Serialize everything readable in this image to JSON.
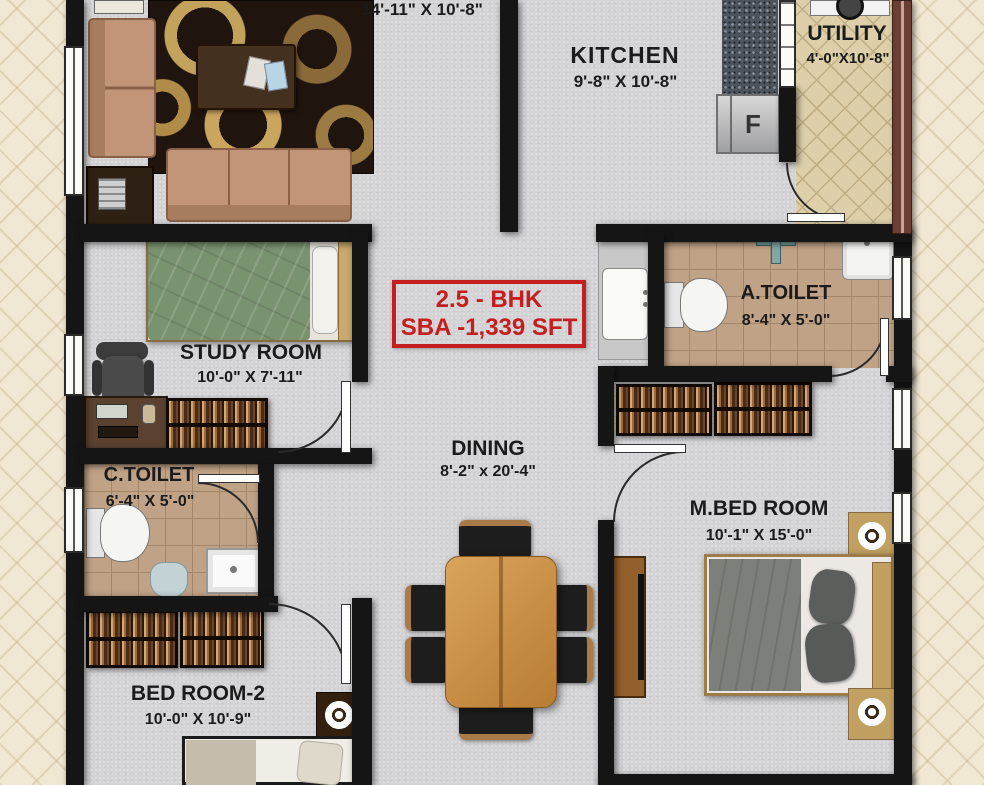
{
  "badge": {
    "line1": "2.5 - BHK",
    "line2": "SBA -1,339 SFT"
  },
  "rooms": {
    "living": {
      "dims": "14'-11\" X 10'-8\""
    },
    "kitchen": {
      "name": "KITCHEN",
      "dims": "9'-8\" X 10'-8\""
    },
    "utility": {
      "name": "UTILITY",
      "dims": "4'-0\"X10'-8\""
    },
    "a_toilet": {
      "name": "A.TOILET",
      "dims": "8'-4\" X 5'-0\""
    },
    "study": {
      "name": "STUDY ROOM",
      "dims": "10'-0\" X 7'-11\""
    },
    "dining": {
      "name": "DINING",
      "dims": "8'-2\" x 20'-4\""
    },
    "c_toilet": {
      "name": "C.TOILET",
      "dims": "6'-4\" X 5'-0\""
    },
    "m_bed": {
      "name": "M.BED ROOM",
      "dims": "10'-1\" X 15'-0\""
    },
    "bed2": {
      "name": "BED ROOM-2",
      "dims": "10'-0\" X 10'-9\""
    }
  },
  "appliances": {
    "fridge_label": "F"
  },
  "colors": {
    "accent_red": "#c41e1e",
    "wall_black": "#151515",
    "floor_gray": "#d3d3d5",
    "toilet_tile": "#c0a287",
    "utility_tile": "#dccfa9",
    "background_cream": "#f1e8d4"
  }
}
